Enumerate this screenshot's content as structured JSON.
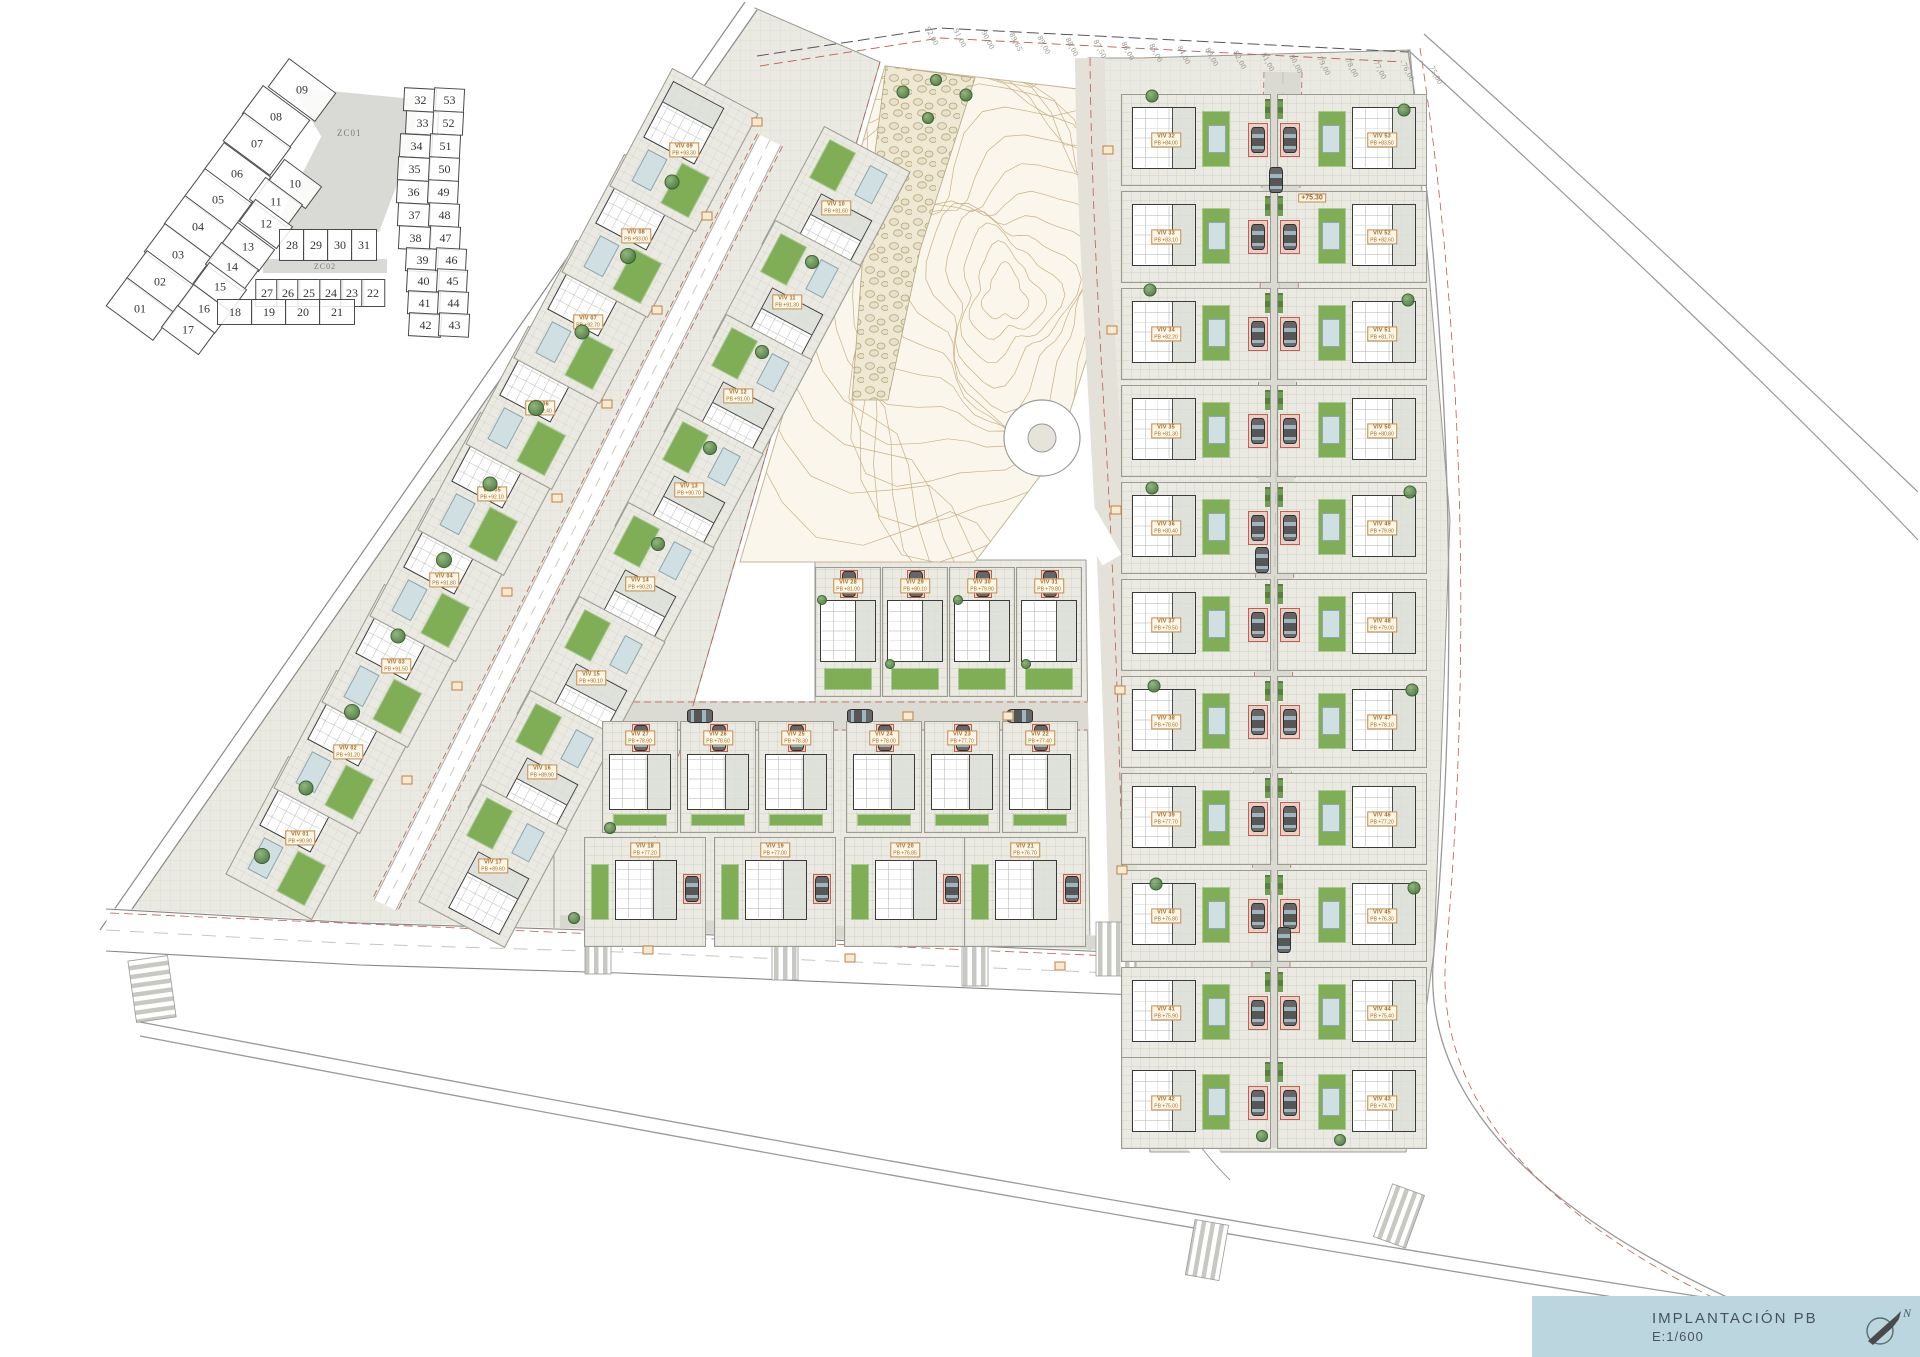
{
  "title_block": {
    "title": "IMPLANTACIÓN PB",
    "scale": "E:1/600",
    "north_label": "N",
    "bg_color": "#bcd6e0"
  },
  "key_plan": {
    "zones": [
      {
        "label": "ZC01"
      },
      {
        "label": "ZC02"
      }
    ],
    "outer_cells": [
      {
        "n": "09",
        "x": 217,
        "y": 38
      },
      {
        "n": "08",
        "x": 191,
        "y": 65
      },
      {
        "n": "07",
        "x": 172,
        "y": 92
      },
      {
        "n": "06",
        "x": 152,
        "y": 122
      },
      {
        "n": "05",
        "x": 133,
        "y": 148
      },
      {
        "n": "04",
        "x": 113,
        "y": 175
      },
      {
        "n": "03",
        "x": 93,
        "y": 203
      },
      {
        "n": "02",
        "x": 75,
        "y": 230
      },
      {
        "n": "01",
        "x": 55,
        "y": 257
      }
    ],
    "inner_cells": [
      {
        "n": "10",
        "x": 210,
        "y": 132
      },
      {
        "n": "11",
        "x": 191,
        "y": 150
      },
      {
        "n": "12",
        "x": 181,
        "y": 172
      },
      {
        "n": "13",
        "x": 163,
        "y": 195
      },
      {
        "n": "14",
        "x": 147,
        "y": 215
      },
      {
        "n": "15",
        "x": 135,
        "y": 235
      },
      {
        "n": "16",
        "x": 119,
        "y": 257
      },
      {
        "n": "17",
        "x": 103,
        "y": 278
      }
    ],
    "row_a_cells": [
      {
        "n": "28",
        "x": 207,
        "y": 193
      },
      {
        "n": "29",
        "x": 231,
        "y": 193
      },
      {
        "n": "30",
        "x": 255,
        "y": 193
      },
      {
        "n": "31",
        "x": 279,
        "y": 193
      }
    ],
    "row_b_cells": [
      {
        "n": "27",
        "x": 182,
        "y": 241
      },
      {
        "n": "26",
        "x": 203,
        "y": 241
      },
      {
        "n": "25",
        "x": 224,
        "y": 241
      },
      {
        "n": "24",
        "x": 246,
        "y": 241
      },
      {
        "n": "23",
        "x": 267,
        "y": 241
      },
      {
        "n": "22",
        "x": 288,
        "y": 241
      }
    ],
    "row_c_cells": [
      {
        "n": "18",
        "x": 150,
        "y": 260
      },
      {
        "n": "19",
        "x": 184,
        "y": 260
      },
      {
        "n": "20",
        "x": 218,
        "y": 260
      },
      {
        "n": "21",
        "x": 252,
        "y": 260
      }
    ],
    "pair_left_cells": [
      {
        "n": "32",
        "x": 335,
        "y": 48
      },
      {
        "n": "33",
        "x": 337,
        "y": 71
      },
      {
        "n": "34",
        "x": 331,
        "y": 94
      },
      {
        "n": "35",
        "x": 329,
        "y": 117
      },
      {
        "n": "36",
        "x": 328,
        "y": 140
      },
      {
        "n": "37",
        "x": 329,
        "y": 163
      },
      {
        "n": "38",
        "x": 330,
        "y": 186
      },
      {
        "n": "39",
        "x": 337,
        "y": 208
      },
      {
        "n": "40",
        "x": 338,
        "y": 229
      },
      {
        "n": "41",
        "x": 339,
        "y": 251
      },
      {
        "n": "42",
        "x": 340,
        "y": 273
      }
    ],
    "pair_right_cells": [
      {
        "n": "53",
        "x": 364,
        "y": 48
      },
      {
        "n": "52",
        "x": 363,
        "y": 71
      },
      {
        "n": "51",
        "x": 360,
        "y": 94
      },
      {
        "n": "50",
        "x": 359,
        "y": 117
      },
      {
        "n": "49",
        "x": 358,
        "y": 140
      },
      {
        "n": "48",
        "x": 359,
        "y": 163
      },
      {
        "n": "47",
        "x": 360,
        "y": 186
      },
      {
        "n": "46",
        "x": 366,
        "y": 208
      },
      {
        "n": "45",
        "x": 367,
        "y": 229
      },
      {
        "n": "44",
        "x": 368,
        "y": 251
      },
      {
        "n": "43",
        "x": 369,
        "y": 273
      }
    ]
  },
  "site": {
    "left_west": [
      {
        "label": "VIV 01",
        "elev": "PB +90.90",
        "x": 300,
        "y": 838
      },
      {
        "label": "VIV 02",
        "elev": "PB +91.20",
        "x": 348,
        "y": 752
      },
      {
        "label": "VIV 03",
        "elev": "PB +91.50",
        "x": 396,
        "y": 666
      },
      {
        "label": "VIV 04",
        "elev": "PB +91.80",
        "x": 444,
        "y": 580
      },
      {
        "label": "VIV 05",
        "elev": "PB +92.10",
        "x": 492,
        "y": 494
      },
      {
        "label": "VIV 06",
        "elev": "PB +92.40",
        "x": 540,
        "y": 408
      },
      {
        "label": "VIV 07",
        "elev": "PB +92.70",
        "x": 588,
        "y": 322
      },
      {
        "label": "VIV 08",
        "elev": "PB +93.00",
        "x": 636,
        "y": 236
      },
      {
        "label": "VIV 09",
        "elev": "PB +93.30",
        "x": 684,
        "y": 150
      }
    ],
    "left_east": [
      {
        "label": "VIV 10",
        "elev": "PB +91.60",
        "x": 836,
        "y": 208
      },
      {
        "label": "VIV 11",
        "elev": "PB +91.30",
        "x": 787,
        "y": 302
      },
      {
        "label": "VIV 12",
        "elev": "PB +91.00",
        "x": 738,
        "y": 396
      },
      {
        "label": "VIV 13",
        "elev": "PB +90.70",
        "x": 689,
        "y": 490
      },
      {
        "label": "VIV 14",
        "elev": "PB +90.20",
        "x": 640,
        "y": 584
      },
      {
        "label": "VIV 15",
        "elev": "PB +90.10",
        "x": 591,
        "y": 678
      },
      {
        "label": "VIV 16",
        "elev": "PB +89.90",
        "x": 542,
        "y": 772
      },
      {
        "label": "VIV 17",
        "elev": "PB +89.60",
        "x": 493,
        "y": 866
      }
    ],
    "mid_top": [
      {
        "label": "VIV 28",
        "elev": "PB +81.00",
        "x": 848,
        "y": 632
      },
      {
        "label": "VIV 29",
        "elev": "PB +80.10",
        "x": 915,
        "y": 632
      },
      {
        "label": "VIV 30",
        "elev": "PB +79.90",
        "x": 982,
        "y": 632
      },
      {
        "label": "VIV 31",
        "elev": "PB +79.80",
        "x": 1049,
        "y": 632
      }
    ],
    "mid_main": [
      {
        "label": "VIV 27",
        "elev": "PB +78.90",
        "x": 640,
        "y": 777
      },
      {
        "label": "VIV 26",
        "elev": "PB +78.60",
        "x": 718,
        "y": 777
      },
      {
        "label": "VIV 25",
        "elev": "PB +78.30",
        "x": 796,
        "y": 777
      },
      {
        "label": "VIV 24",
        "elev": "PB +78.00",
        "x": 884,
        "y": 777
      },
      {
        "label": "VIV 23",
        "elev": "PB +77.70",
        "x": 962,
        "y": 777
      },
      {
        "label": "VIV 22",
        "elev": "PB +77.40",
        "x": 1040,
        "y": 777
      }
    ],
    "mid_south": [
      {
        "label": "VIV 18",
        "elev": "PB +77.20",
        "x": 645,
        "y": 892
      },
      {
        "label": "VIV 19",
        "elev": "PB +77.00",
        "x": 775,
        "y": 892
      },
      {
        "label": "VIV 20",
        "elev": "PB +76.85",
        "x": 905,
        "y": 892
      },
      {
        "label": "VIV 21",
        "elev": "PB +76.70",
        "x": 1025,
        "y": 892
      }
    ],
    "right_west_col": [
      {
        "label": "VIV 32",
        "elev": "PB +84.00",
        "x": 1196,
        "y": 140
      },
      {
        "label": "VIV 33",
        "elev": "PB +83.10",
        "x": 1196,
        "y": 237
      },
      {
        "label": "VIV 34",
        "elev": "PB +82.20",
        "x": 1196,
        "y": 334
      },
      {
        "label": "VIV 35",
        "elev": "PB +81.30",
        "x": 1196,
        "y": 431
      },
      {
        "label": "VIV 36",
        "elev": "PB +80.40",
        "x": 1196,
        "y": 528
      },
      {
        "label": "VIV 37",
        "elev": "PB +79.50",
        "x": 1196,
        "y": 625
      },
      {
        "label": "VIV 38",
        "elev": "PB +78.60",
        "x": 1196,
        "y": 722
      },
      {
        "label": "VIV 39",
        "elev": "PB +77.70",
        "x": 1196,
        "y": 819
      },
      {
        "label": "VIV 40",
        "elev": "PB +76.80",
        "x": 1196,
        "y": 916
      },
      {
        "label": "VIV 41",
        "elev": "PB +75.90",
        "x": 1196,
        "y": 1013
      },
      {
        "label": "VIV 42",
        "elev": "PB +75.00",
        "x": 1196,
        "y": 1103
      }
    ],
    "right_east_col": [
      {
        "label": "VIV 53",
        "elev": "PB +83.50",
        "x": 1352,
        "y": 140
      },
      {
        "label": "VIV 52",
        "elev": "PB +82.60",
        "x": 1352,
        "y": 237
      },
      {
        "label": "VIV 51",
        "elev": "PB +81.70",
        "x": 1352,
        "y": 334
      },
      {
        "label": "VIV 50",
        "elev": "PB +80.80",
        "x": 1352,
        "y": 431
      },
      {
        "label": "VIV 49",
        "elev": "PB +79.90",
        "x": 1352,
        "y": 528
      },
      {
        "label": "VIV 48",
        "elev": "PB +79.00",
        "x": 1352,
        "y": 625
      },
      {
        "label": "VIV 47",
        "elev": "PB +78.10",
        "x": 1352,
        "y": 722
      },
      {
        "label": "VIV 46",
        "elev": "PB +77.20",
        "x": 1352,
        "y": 819
      },
      {
        "label": "VIV 45",
        "elev": "PB +76.30",
        "x": 1352,
        "y": 916
      },
      {
        "label": "VIV 44",
        "elev": "PB +75.40",
        "x": 1352,
        "y": 1013
      },
      {
        "label": "VIV 43",
        "elev": "PB +74.70",
        "x": 1352,
        "y": 1103
      }
    ],
    "boundary_elevations": [
      {
        "t": "92,00",
        "x": 932,
        "y": 36
      },
      {
        "t": "91,00",
        "x": 960,
        "y": 38
      },
      {
        "t": "90,00",
        "x": 988,
        "y": 40
      },
      {
        "t": "89,65",
        "x": 1016,
        "y": 42
      },
      {
        "t": "89,00",
        "x": 1044,
        "y": 45
      },
      {
        "t": "88,00",
        "x": 1072,
        "y": 47
      },
      {
        "t": "87,50",
        "x": 1100,
        "y": 49
      },
      {
        "t": "86,00",
        "x": 1128,
        "y": 51
      },
      {
        "t": "85,00",
        "x": 1156,
        "y": 53
      },
      {
        "t": "84,00",
        "x": 1184,
        "y": 55
      },
      {
        "t": "83,00",
        "x": 1212,
        "y": 57
      },
      {
        "t": "82,00",
        "x": 1240,
        "y": 60
      },
      {
        "t": "81,00",
        "x": 1268,
        "y": 62
      },
      {
        "t": "80,00",
        "x": 1296,
        "y": 64
      },
      {
        "t": "79,00",
        "x": 1324,
        "y": 66
      },
      {
        "t": "78,00",
        "x": 1352,
        "y": 68
      },
      {
        "t": "77,00",
        "x": 1380,
        "y": 70
      },
      {
        "t": "76,00",
        "x": 1408,
        "y": 72
      },
      {
        "t": "75,00",
        "x": 1436,
        "y": 75
      }
    ],
    "road_elev_labels": [
      {
        "t": "+75.30",
        "x": 1312,
        "y": 198
      }
    ],
    "road_tags": [
      {
        "x": 757,
        "y": 122
      },
      {
        "x": 707,
        "y": 216
      },
      {
        "x": 657,
        "y": 310
      },
      {
        "x": 607,
        "y": 404
      },
      {
        "x": 557,
        "y": 498
      },
      {
        "x": 507,
        "y": 592
      },
      {
        "x": 457,
        "y": 686
      },
      {
        "x": 407,
        "y": 780
      },
      {
        "x": 1108,
        "y": 150
      },
      {
        "x": 1112,
        "y": 330
      },
      {
        "x": 1116,
        "y": 510
      },
      {
        "x": 1120,
        "y": 690
      },
      {
        "x": 1122,
        "y": 870
      },
      {
        "x": 908,
        "y": 716
      },
      {
        "x": 1008,
        "y": 716
      },
      {
        "x": 648,
        "y": 950
      },
      {
        "x": 850,
        "y": 958
      },
      {
        "x": 1060,
        "y": 966
      }
    ],
    "trees": [
      {
        "x": 262,
        "y": 856,
        "w": 16,
        "h": 16
      },
      {
        "x": 306,
        "y": 788,
        "w": 15,
        "h": 15
      },
      {
        "x": 352,
        "y": 712,
        "w": 16,
        "h": 16
      },
      {
        "x": 398,
        "y": 636,
        "w": 15,
        "h": 15
      },
      {
        "x": 444,
        "y": 560,
        "w": 16,
        "h": 16
      },
      {
        "x": 490,
        "y": 484,
        "w": 15,
        "h": 15
      },
      {
        "x": 536,
        "y": 408,
        "w": 16,
        "h": 16
      },
      {
        "x": 582,
        "y": 332,
        "w": 15,
        "h": 15
      },
      {
        "x": 628,
        "y": 256,
        "w": 16,
        "h": 16
      },
      {
        "x": 672,
        "y": 182,
        "w": 15,
        "h": 15
      },
      {
        "x": 903,
        "y": 92,
        "w": 13,
        "h": 13
      },
      {
        "x": 936,
        "y": 80,
        "w": 12,
        "h": 12
      },
      {
        "x": 966,
        "y": 95,
        "w": 13,
        "h": 13
      },
      {
        "x": 928,
        "y": 118,
        "w": 12,
        "h": 12
      },
      {
        "x": 812,
        "y": 262,
        "w": 14,
        "h": 14
      },
      {
        "x": 762,
        "y": 352,
        "w": 14,
        "h": 14
      },
      {
        "x": 710,
        "y": 448,
        "w": 14,
        "h": 14
      },
      {
        "x": 658,
        "y": 544,
        "w": 14,
        "h": 14
      },
      {
        "x": 822,
        "y": 600,
        "w": 10,
        "h": 10
      },
      {
        "x": 890,
        "y": 664,
        "w": 10,
        "h": 10
      },
      {
        "x": 958,
        "y": 600,
        "w": 10,
        "h": 10
      },
      {
        "x": 1026,
        "y": 664,
        "w": 10,
        "h": 10
      },
      {
        "x": 1152,
        "y": 96,
        "w": 13,
        "h": 13
      },
      {
        "x": 1404,
        "y": 110,
        "w": 13,
        "h": 13
      },
      {
        "x": 1150,
        "y": 290,
        "w": 13,
        "h": 13
      },
      {
        "x": 1408,
        "y": 300,
        "w": 13,
        "h": 13
      },
      {
        "x": 1152,
        "y": 488,
        "w": 13,
        "h": 13
      },
      {
        "x": 1410,
        "y": 492,
        "w": 13,
        "h": 13
      },
      {
        "x": 1154,
        "y": 686,
        "w": 13,
        "h": 13
      },
      {
        "x": 1412,
        "y": 690,
        "w": 13,
        "h": 13
      },
      {
        "x": 1156,
        "y": 884,
        "w": 13,
        "h": 13
      },
      {
        "x": 1414,
        "y": 888,
        "w": 13,
        "h": 13
      },
      {
        "x": 1262,
        "y": 1136,
        "w": 12,
        "h": 12
      },
      {
        "x": 1340,
        "y": 1140,
        "w": 12,
        "h": 12
      },
      {
        "x": 610,
        "y": 828,
        "w": 12,
        "h": 12
      },
      {
        "x": 574,
        "y": 918,
        "w": 12,
        "h": 12
      }
    ],
    "road_cars_vertical": [
      {
        "x": 1276,
        "y": 180
      },
      {
        "x": 1262,
        "y": 560
      },
      {
        "x": 1284,
        "y": 940
      }
    ],
    "road_cars_horizontal": [
      {
        "x": 700,
        "y": 716
      },
      {
        "x": 860,
        "y": 716
      },
      {
        "x": 1020,
        "y": 716
      }
    ]
  }
}
